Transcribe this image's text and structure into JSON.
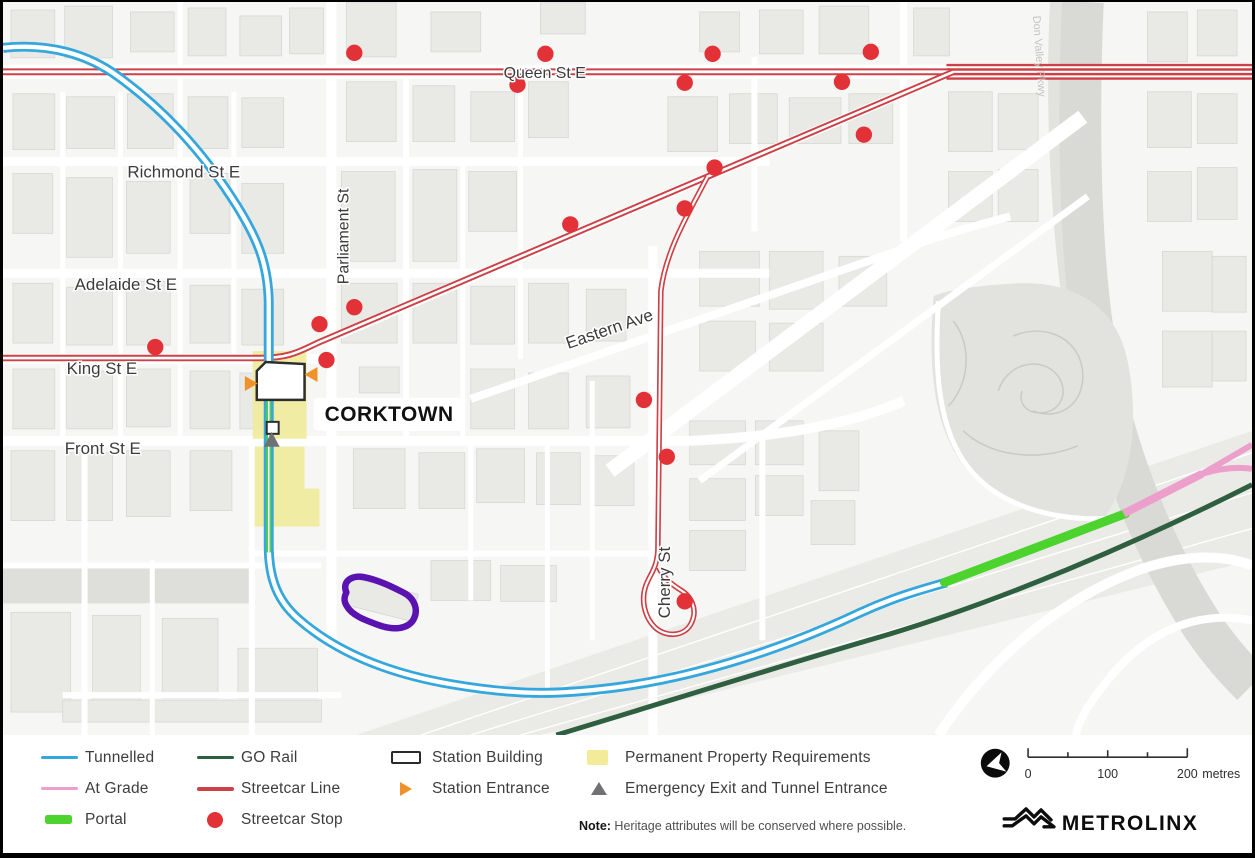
{
  "map": {
    "station_callout": "CORKTOWN",
    "street_labels": [
      {
        "name": "queen",
        "label": "Queen St E"
      },
      {
        "name": "richmond",
        "label": "Richmond St E"
      },
      {
        "name": "adelaide",
        "label": "Adelaide St E"
      },
      {
        "name": "king",
        "label": "King St E"
      },
      {
        "name": "front",
        "label": "Front St E"
      },
      {
        "name": "parliament",
        "label": "Parliament St"
      },
      {
        "name": "eastern",
        "label": "Eastern Ave"
      },
      {
        "name": "cherry",
        "label": "Cherry St"
      },
      {
        "name": "dvp",
        "label": "Don Valley Pkwy"
      }
    ],
    "streetcar_stops": [
      [
        353,
        51
      ],
      [
        545,
        52
      ],
      [
        713,
        52
      ],
      [
        872,
        50
      ],
      [
        517,
        83
      ],
      [
        685,
        81
      ],
      [
        843,
        80
      ],
      [
        865,
        133
      ],
      [
        715,
        166
      ],
      [
        685,
        207
      ],
      [
        570,
        223
      ],
      [
        353,
        306
      ],
      [
        318,
        323
      ],
      [
        325,
        359
      ],
      [
        153,
        346
      ],
      [
        644,
        399
      ],
      [
        667,
        456
      ],
      [
        685,
        601
      ]
    ]
  },
  "colors": {
    "tunnelled": "#35a7dc",
    "atgrade": "#ec9fcb",
    "portal": "#4cd32e",
    "gorail": "#2f5f41",
    "streetcar": "#cd4046",
    "stop": "#e23238",
    "entrance": "#f0912b",
    "emergency": "#6f7174",
    "property": "#f1eb9a",
    "purple": "#5a12b0"
  },
  "legend": {
    "columns": [
      {
        "items": [
          {
            "label": "Tunnelled"
          },
          {
            "label": "At Grade"
          },
          {
            "label": "Portal"
          }
        ]
      },
      {
        "items": [
          {
            "label": "GO Rail"
          },
          {
            "label": "Streetcar Line"
          },
          {
            "label": "Streetcar Stop"
          }
        ]
      },
      {
        "items": [
          {
            "label": "Station Building"
          },
          {
            "label": "Station Entrance"
          }
        ]
      },
      {
        "items": [
          {
            "label": "Permanent Property Requirements"
          },
          {
            "label": "Emergency Exit and Tunnel Entrance"
          }
        ]
      }
    ],
    "note_label": "Note:",
    "note_text": " Heritage attributes will be conserved where possible."
  },
  "scalebar": {
    "tick0": "0",
    "tick100": "100",
    "tick200": "200",
    "unit": "metres"
  },
  "logo": "METROLINX"
}
